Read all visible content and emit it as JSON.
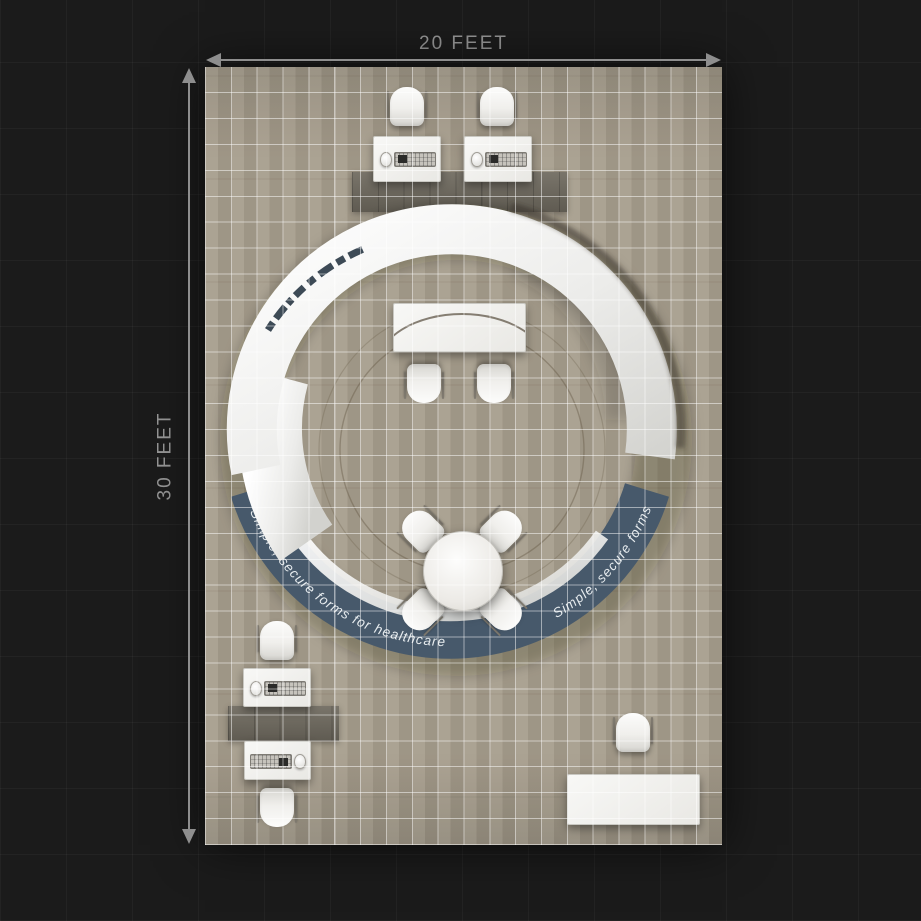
{
  "dimensions": {
    "width_label": "20 FEET",
    "height_label": "30 FEET",
    "line_color": "#8e8e8e"
  },
  "ring": {
    "tagline_left": "Simple, secure forms for healthcare",
    "tagline_right": "Simple, secure forms for healthcare",
    "band_color": "#47596b",
    "panel_color": "#ebebe8",
    "tagline_text_color": "#e7ecef",
    "logo_mark": "stylized-wordmark-illegible"
  },
  "floor": {
    "grid_columns": 20,
    "grid_rows": 30,
    "wood_color": "#a79e8d",
    "grid_line_color": "#ffffff",
    "inlay_color": "#6f6a5f"
  },
  "furniture_counts": {
    "chairs": 11,
    "workstation_desks": 4,
    "tables": 3,
    "wood_inlays": 2
  },
  "colors": {
    "background": "#1b1b1b",
    "dimension_text": "#949494"
  }
}
